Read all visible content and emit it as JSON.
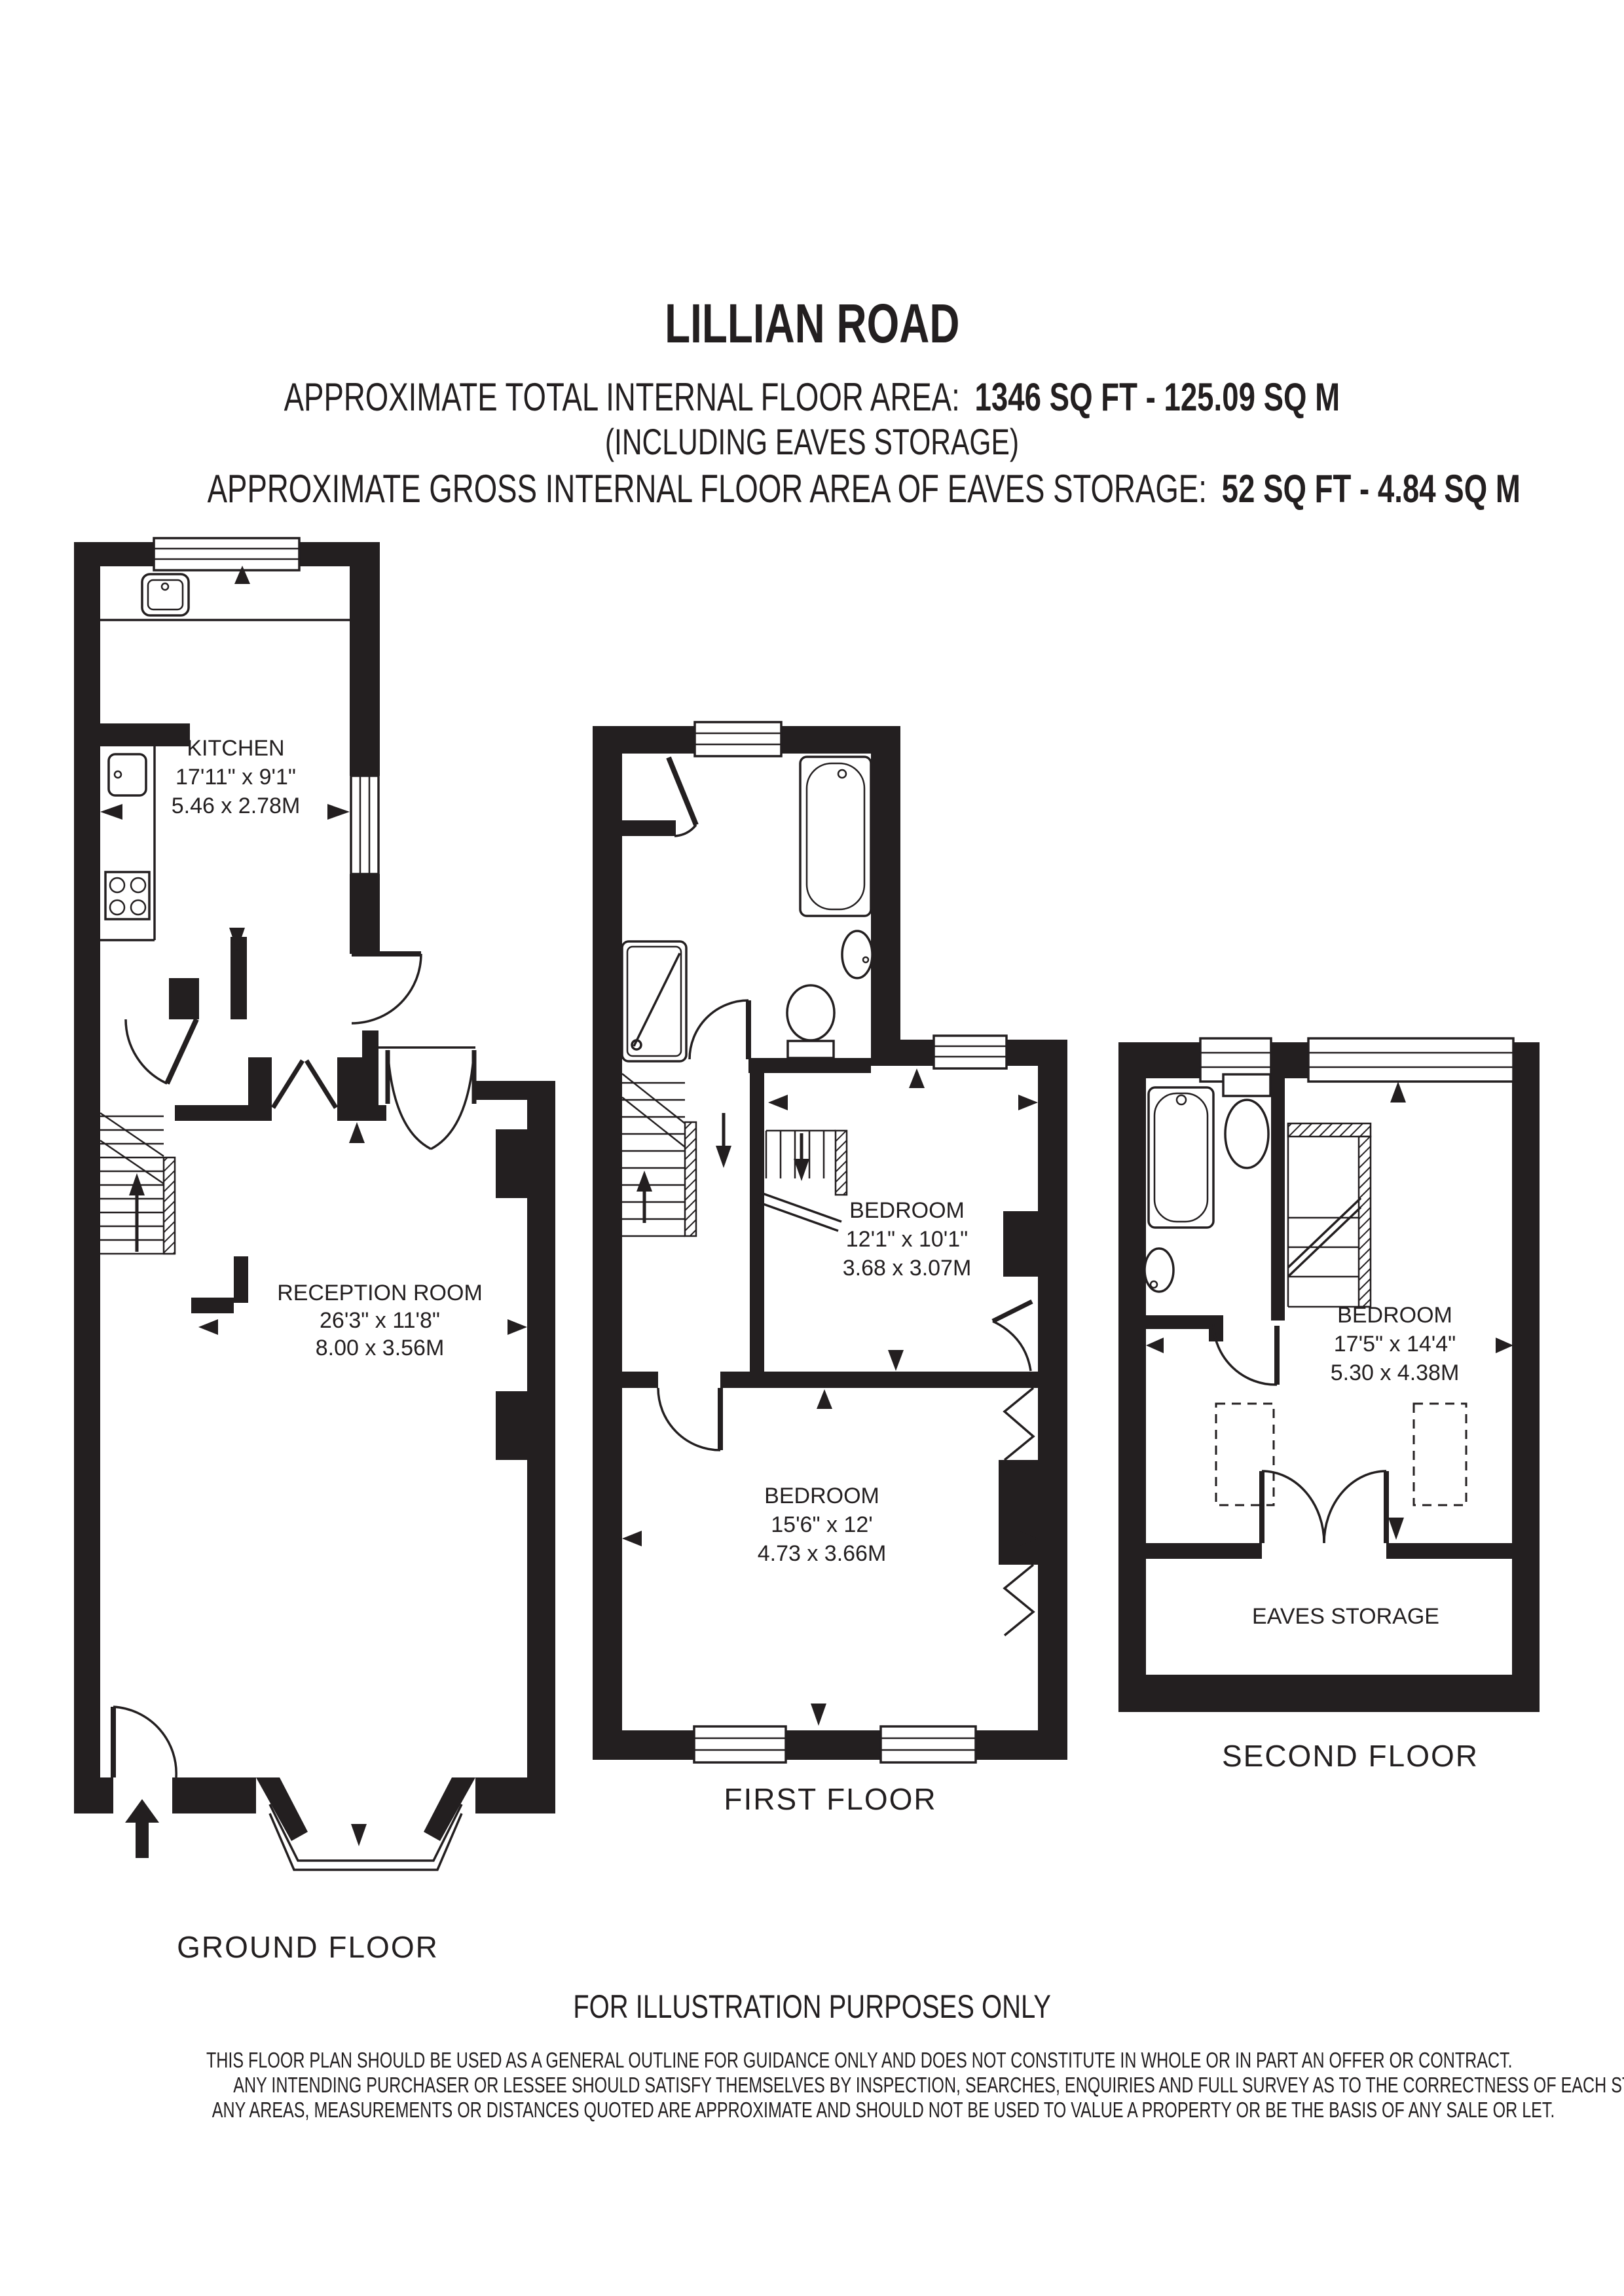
{
  "colors": {
    "ink": "#231f20",
    "paper": "#ffffff"
  },
  "header": {
    "title": "LILLIAN ROAD",
    "total_label": "APPROXIMATE TOTAL INTERNAL FLOOR AREA:",
    "total_value": "1346 SQ FT  -  125.09 SQ M",
    "including": "(INCLUDING EAVES STORAGE)",
    "eaves_label": "APPROXIMATE GROSS INTERNAL FLOOR AREA OF EAVES STORAGE:",
    "eaves_value": "52 SQ FT  -  4.84 SQ M"
  },
  "floors": {
    "ground": {
      "label": "GROUND FLOOR",
      "kitchen": {
        "name": "KITCHEN",
        "imperial": "17'11\" x 9'1\"",
        "metric": "5.46 x 2.78M"
      },
      "reception": {
        "name": "RECEPTION ROOM",
        "imperial": "26'3\" x 11'8\"",
        "metric": "8.00 x 3.56M"
      }
    },
    "first": {
      "label": "FIRST FLOOR",
      "bedroom_small": {
        "name": "BEDROOM",
        "imperial": "12'1\" x 10'1\"",
        "metric": "3.68 x 3.07M"
      },
      "bedroom_large": {
        "name": "BEDROOM",
        "imperial": "15'6\" x 12'",
        "metric": "4.73 x 3.66M"
      }
    },
    "second": {
      "label": "SECOND FLOOR",
      "bedroom": {
        "name": "BEDROOM",
        "imperial": "17'5\" x 14'4\"",
        "metric": "5.30 x 4.38M"
      },
      "eaves": {
        "name": "EAVES STORAGE"
      }
    }
  },
  "footer": {
    "notice": "FOR ILLUSTRATION PURPOSES ONLY",
    "disclaimer1": "THIS FLOOR PLAN SHOULD BE USED AS A GENERAL OUTLINE FOR GUIDANCE ONLY AND DOES NOT CONSTITUTE IN WHOLE OR IN PART AN OFFER OR CONTRACT.",
    "disclaimer2": "ANY INTENDING PURCHASER OR LESSEE SHOULD SATISFY THEMSELVES BY INSPECTION, SEARCHES, ENQUIRIES AND FULL SURVEY AS TO THE CORRECTNESS OF EACH STATEMENT.",
    "disclaimer3": "ANY AREAS, MEASUREMENTS OR DISTANCES QUOTED ARE APPROXIMATE AND SHOULD NOT BE USED TO VALUE A PROPERTY OR BE THE BASIS OF ANY SALE OR LET."
  }
}
